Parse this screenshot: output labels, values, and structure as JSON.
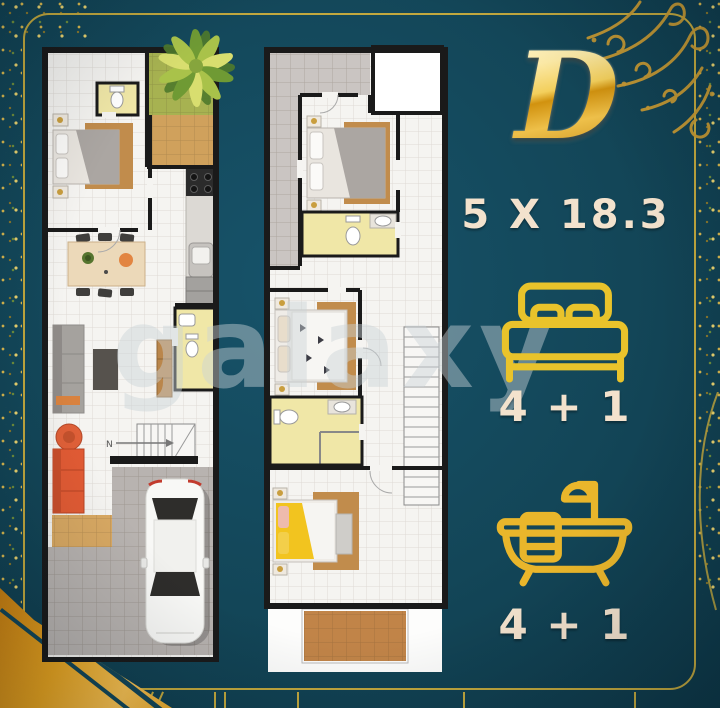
{
  "unit": {
    "type_label": "D",
    "dimensions": "5 X 18.3",
    "bedrooms_label": "4 + 1",
    "bathrooms_label": "4 + 1"
  },
  "watermark_text": "galaxy",
  "floor_plan_1": {
    "stairs_direction_label": "N"
  },
  "icons": {
    "bedrooms": "bed-icon",
    "bathrooms": "bathtub-icon",
    "garden": "palm-tree-icon"
  },
  "colors": {
    "background_teal": "#134658",
    "frame_gold": "#c2a83e",
    "icon_gold": "#e8bd28",
    "text_cream": "#f3e2cd",
    "letter_gold_light": "#fbe9a6",
    "letter_gold_dark": "#b97c0b",
    "grass_green": "#a7b251",
    "terrace_tan": "#d0a15c",
    "bathroom_yellow": "#f0e7a7",
    "carport_gray": "#b8b3b0",
    "wood_brown": "#c18c4c",
    "sofa_orange": "#e25b34"
  }
}
